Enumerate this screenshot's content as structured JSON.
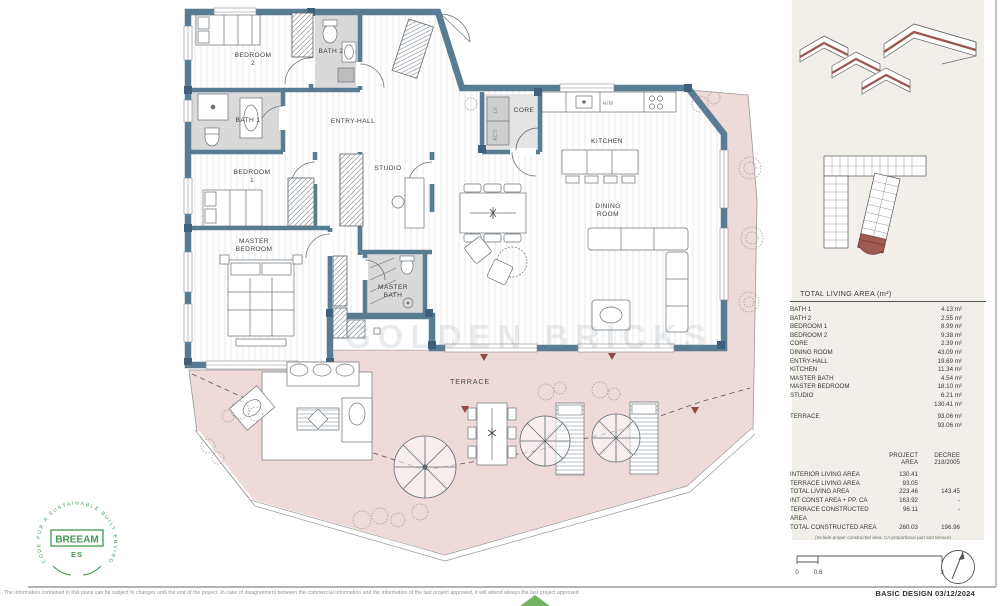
{
  "plan": {
    "labels": {
      "bedroom2_l1": "BEDROOM",
      "bedroom2_l2": "2",
      "bath2": "BATH 2",
      "bath1": "BATH 1",
      "bedroom1_l1": "BEDROOM",
      "bedroom1_l2": "1",
      "entry_hall": "ENTRY-HALL",
      "studio": "STUDIO",
      "master_l1": "MASTER",
      "master_l2": "BEDROOM",
      "masterbath_l1": "MASTER",
      "masterbath_l2": "BATH",
      "core": "CORE",
      "lv": "LV",
      "acs": "ACS",
      "hm": "H/M",
      "kitchen": "KITCHEN",
      "dining_l1": "DINING",
      "dining_l2": "ROOM",
      "terrace": "TERRACE"
    },
    "watermark": "GOLDEN BRICKS"
  },
  "area_table": {
    "title": "TOTAL LIVING AREA (m²)",
    "rows": [
      {
        "label": "BATH 1",
        "value": "4.13 m²"
      },
      {
        "label": "BATH 2",
        "value": "2.55 m²"
      },
      {
        "label": "BEDROOM 1",
        "value": "8.99 m²"
      },
      {
        "label": "BEDROOM 2",
        "value": "9.38 m²"
      },
      {
        "label": "CORE",
        "value": "2.39 m²"
      },
      {
        "label": "DINING ROOM",
        "value": "43.09 m²"
      },
      {
        "label": "ENTRY-HALL",
        "value": "19.69 m²"
      },
      {
        "label": "KITCHEN",
        "value": "11.34 m²"
      },
      {
        "label": "MASTER BATH",
        "value": "4.54 m²"
      },
      {
        "label": "MASTER BEDROOM",
        "value": "18.10 m²"
      },
      {
        "label": "STUDIO",
        "value": "6.21 m²"
      },
      {
        "label": "",
        "value": "130.41 m²"
      },
      {
        "label": "TERRACE",
        "value": "93.06 m²"
      },
      {
        "label": "",
        "value": "93.06 m²"
      }
    ]
  },
  "summary_table": {
    "header_project_l1": "PROJECT",
    "header_project_l2": "AREA",
    "header_decree_l1": "DECREE",
    "header_decree_l2": "218/2005",
    "rows": [
      {
        "label": "INTERIOR LIVING AREA",
        "project": "130.41",
        "decree": ""
      },
      {
        "label": "TERRACE LIVING AREA",
        "project": "93.05",
        "decree": ""
      },
      {
        "label": "TOTAL LIVING AREA",
        "project": "223.46",
        "decree": "143.45"
      },
      {
        "label": "INT CONST AREA + PP. CA",
        "project": "163.92",
        "decree": "-"
      },
      {
        "label": "TERRACE CONSTRUCTED AREA",
        "project": "96.11",
        "decree": "-"
      },
      {
        "label": "TOTAL CONSTRUCTED AREA",
        "project": "260.03",
        "decree": "196.96"
      }
    ],
    "footnote": "(Include proper constructed area, CA proportional part and terrace)"
  },
  "scale_bar": {
    "labels": [
      "0",
      "0.6",
      "3"
    ]
  },
  "breeam": {
    "ring_text": "CODE FOR A SUSTAINABLE BUILT ENVIRONMENT",
    "name": "BREEAM",
    "region": "ES"
  },
  "footer": {
    "disclaimer": "The information contained in this plans can be subject to changes until the end of the project. In case of disagreement between the commercial information and the information of the last project approved, it will attend always the last project approved",
    "title_block": "BASIC DESIGN 03/12/2024"
  },
  "colors": {
    "wall": "#587d93",
    "terrace_pink": "#eedad8",
    "bath_gray": "#d9d9d9",
    "accent_red": "#a05a52",
    "breeam_green": "#3d9a50",
    "panel_beige": "#f2eeea"
  }
}
